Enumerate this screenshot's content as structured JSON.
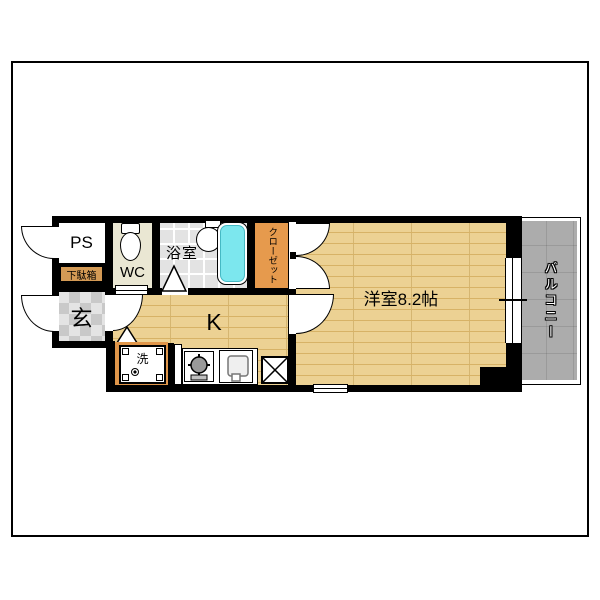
{
  "title": "1K apartment floor plan",
  "rooms": {
    "ps": {
      "label": "PS"
    },
    "shoe_cabinet": {
      "label": "下駄箱"
    },
    "entrance": {
      "label": "玄"
    },
    "wc": {
      "label": "WC"
    },
    "bathroom": {
      "label": "浴室"
    },
    "closet": {
      "label": "クローゼット"
    },
    "kitchen": {
      "label": "K"
    },
    "washing_machine": {
      "label": "洗"
    },
    "western_room": {
      "label": "洋室8.2帖"
    },
    "balcony": {
      "label": "バルコニー"
    }
  },
  "colors": {
    "wall": "#000000",
    "floor_wood": "#ecd193",
    "floor_wood_line": "#d7b266",
    "closet": "#e69a4d",
    "washer_area": "#e0964a",
    "shoe_label": "#d49a55",
    "wc_floor": "#eae7d3",
    "bath_tile": "#e3e3e3",
    "entrance_tile": "#e4e4e4",
    "entrance_tile_dark": "#c9c9c9",
    "balcony": "#acacac",
    "bathtub": "#7ce7ee"
  }
}
